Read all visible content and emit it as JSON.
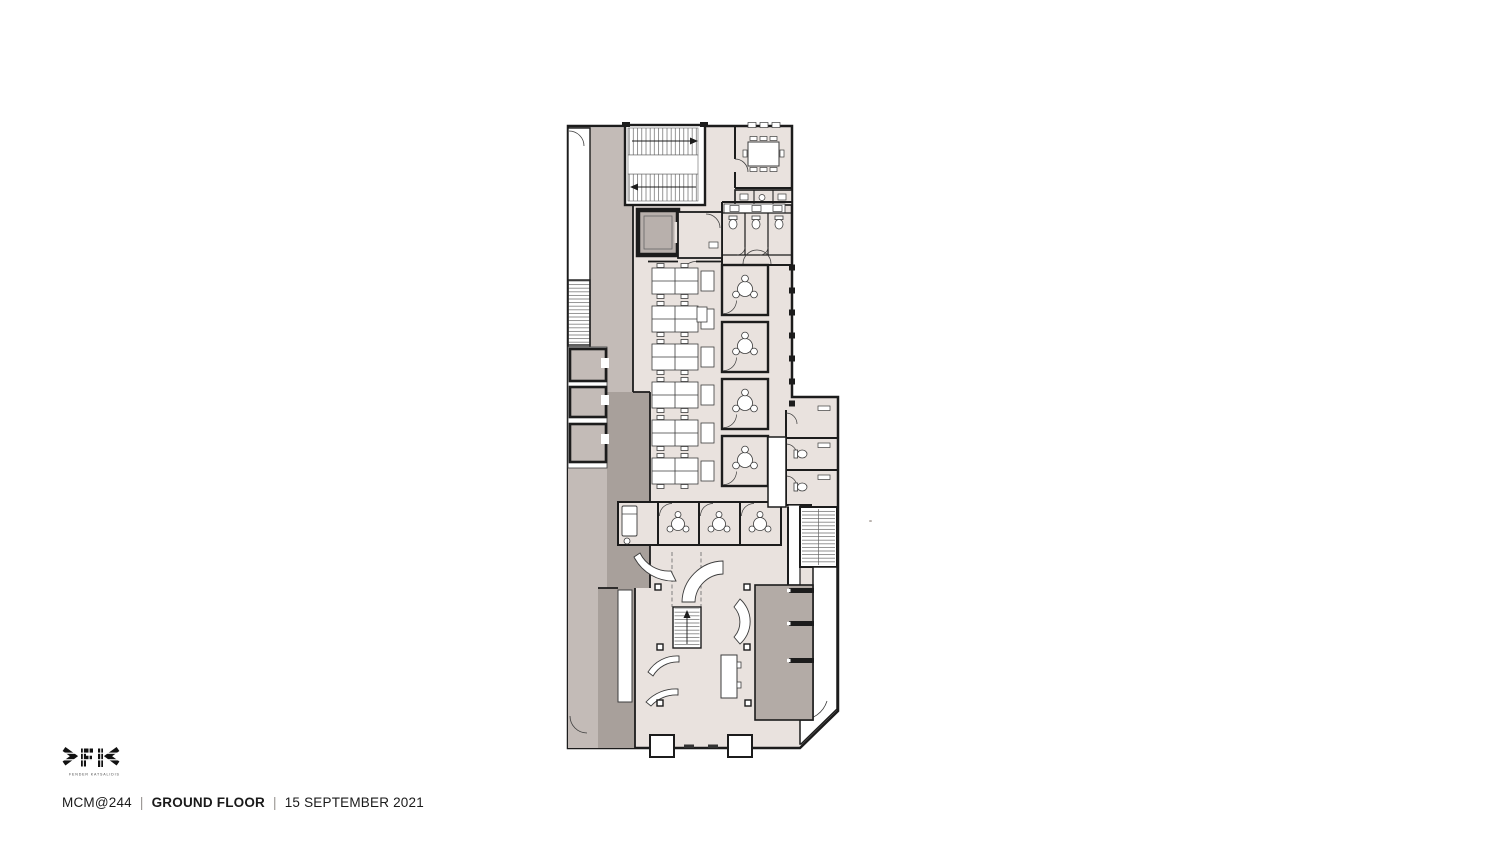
{
  "title_block": {
    "project": "MCM@244",
    "separator": "|",
    "sheet_name": "GROUND FLOOR",
    "date": "15 SEPTEMBER 2021",
    "logo": {
      "mark": "FK",
      "tagline": "FENDER KATSALIDIS"
    }
  },
  "plan": {
    "colors": {
      "paper": "#ffffff",
      "interior": "#e9e2de",
      "circulation": "#c3bbb7",
      "service_dark": "#a8a09b",
      "lift_core": "#b3aba6",
      "elevator_cab": "#b8b0ac",
      "wall": "#1c1c1c",
      "furniture_line": "#3c3c3c"
    },
    "features": [
      "main-stair",
      "fire-stair",
      "elevator",
      "meeting-room",
      "toilets",
      "kitchenette",
      "desk-clusters",
      "meeting-pods",
      "first-aid-room",
      "east-wing",
      "east-wing-stair",
      "lift-core",
      "lobby",
      "reception-desk",
      "entry-doors"
    ]
  }
}
